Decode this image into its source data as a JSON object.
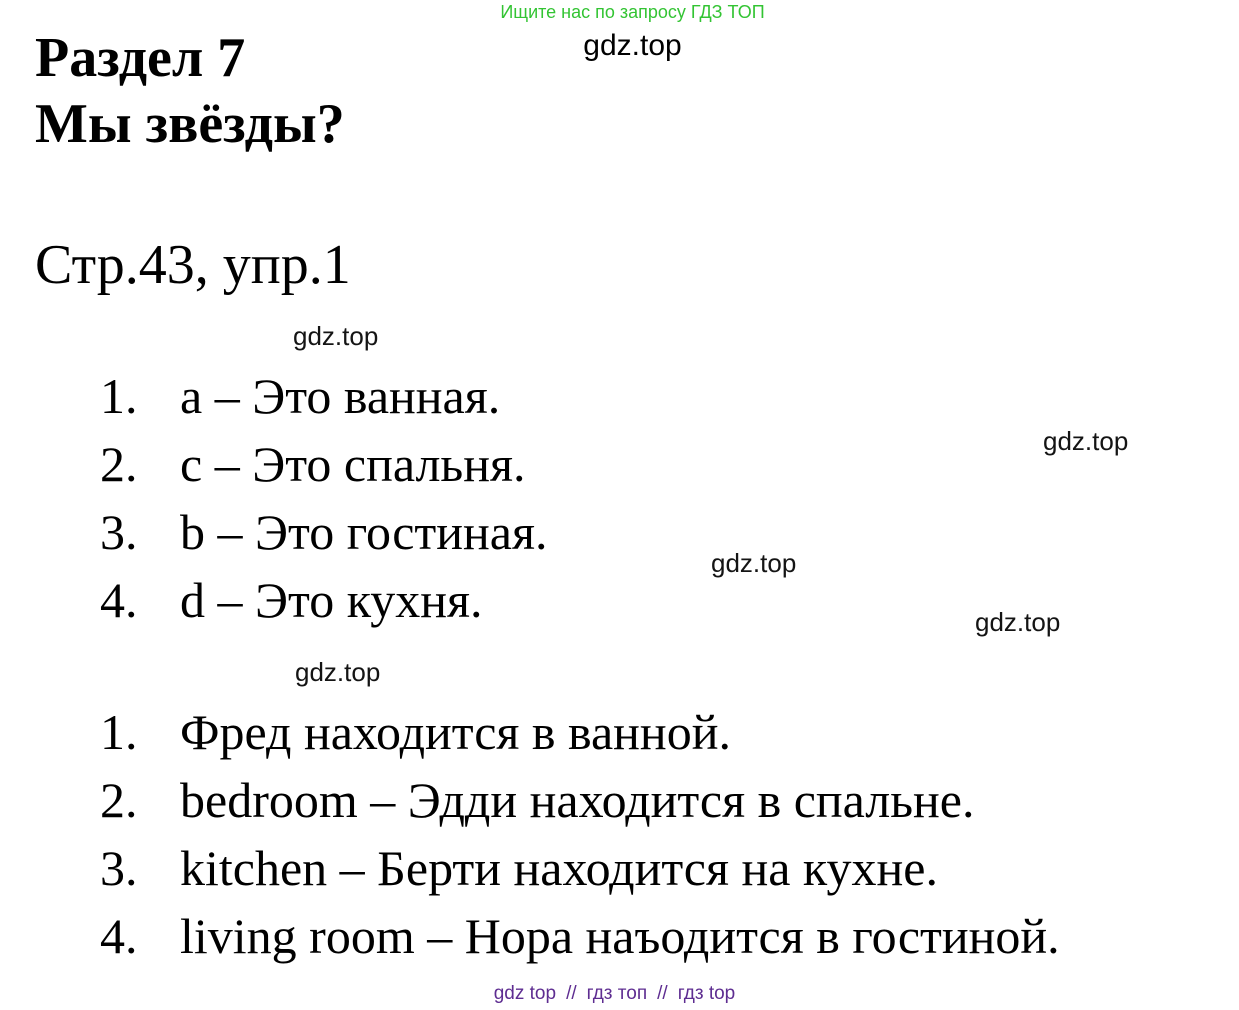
{
  "branding": {
    "promo_text": "Ищите нас по запросу ГДЗ ТОП",
    "watermark_text": "gdz.top",
    "footer": {
      "link1": "gdz top",
      "link2": "гдз топ",
      "link3": "гдз top",
      "separator": "//"
    },
    "colors": {
      "promo_green": "#33c433",
      "footer_purple": "#5e2d91",
      "text_black": "#000000"
    }
  },
  "document": {
    "section_title_line1": "Раздел 7",
    "section_title_line2": "Мы звёзды?",
    "exercise_ref": "Стр.43, упр.1",
    "answers_part1": [
      {
        "num": "1.",
        "text": "a – Это ванная."
      },
      {
        "num": "2.",
        "text": "c – Это спальня."
      },
      {
        "num": "3.",
        "text": "b – Это гостиная."
      },
      {
        "num": "4.",
        "text": "d – Это кухня."
      }
    ],
    "answers_part2": [
      {
        "num": "1.",
        "text": "Фред находится в ванной."
      },
      {
        "num": "2.",
        "text": "bedroom – Эдди находится в спальне."
      },
      {
        "num": "3.",
        "text": "kitchen – Берти находится на кухне."
      },
      {
        "num": "4.",
        "text": "living room – Нора наъодится в гостиной."
      }
    ]
  }
}
